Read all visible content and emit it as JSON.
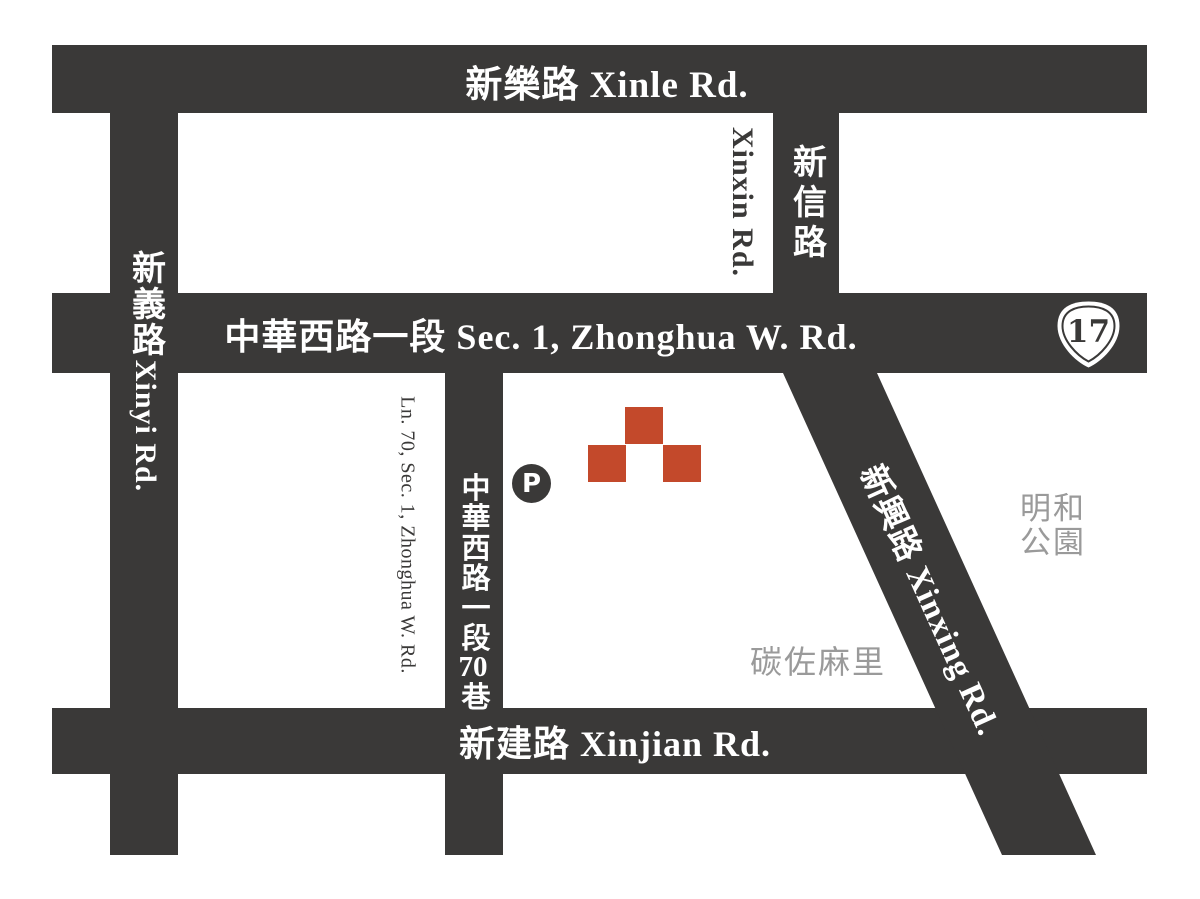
{
  "colors": {
    "road": "#3a3938",
    "marker_red": "#c3492b",
    "muted_gray": "#9a9a9a",
    "background": "#ffffff",
    "label_white": "#ffffff"
  },
  "roads": {
    "xinle": {
      "label": "新樂路 Xinle Rd."
    },
    "zhonghua": {
      "label": "中華西路一段 Sec. 1, Zhonghua W. Rd."
    },
    "xinjian": {
      "label": "新建路 Xinjian Rd."
    },
    "xinyi": {
      "cjk": "新義路",
      "latin": "Xinyi Rd."
    },
    "xinxin": {
      "cjk": "新信路",
      "latin": "Xinxin Rd."
    },
    "lane70": {
      "cjk_prefix": "中華西路一段",
      "cjk_digits": "70",
      "cjk_suffix": "巷",
      "latin": "Ln. 70, Sec. 1, Zhonghua W. Rd."
    },
    "xinxing": {
      "label": "新興路  Xinxing Rd."
    }
  },
  "markers": {
    "parking": {
      "label": "P"
    },
    "route_shield": {
      "number": "17"
    },
    "destination_block_count": 3
  },
  "landmarks": {
    "park": {
      "line1": "明和",
      "line2": "公園"
    },
    "restaurant": {
      "name": "碳佐麻里"
    }
  }
}
